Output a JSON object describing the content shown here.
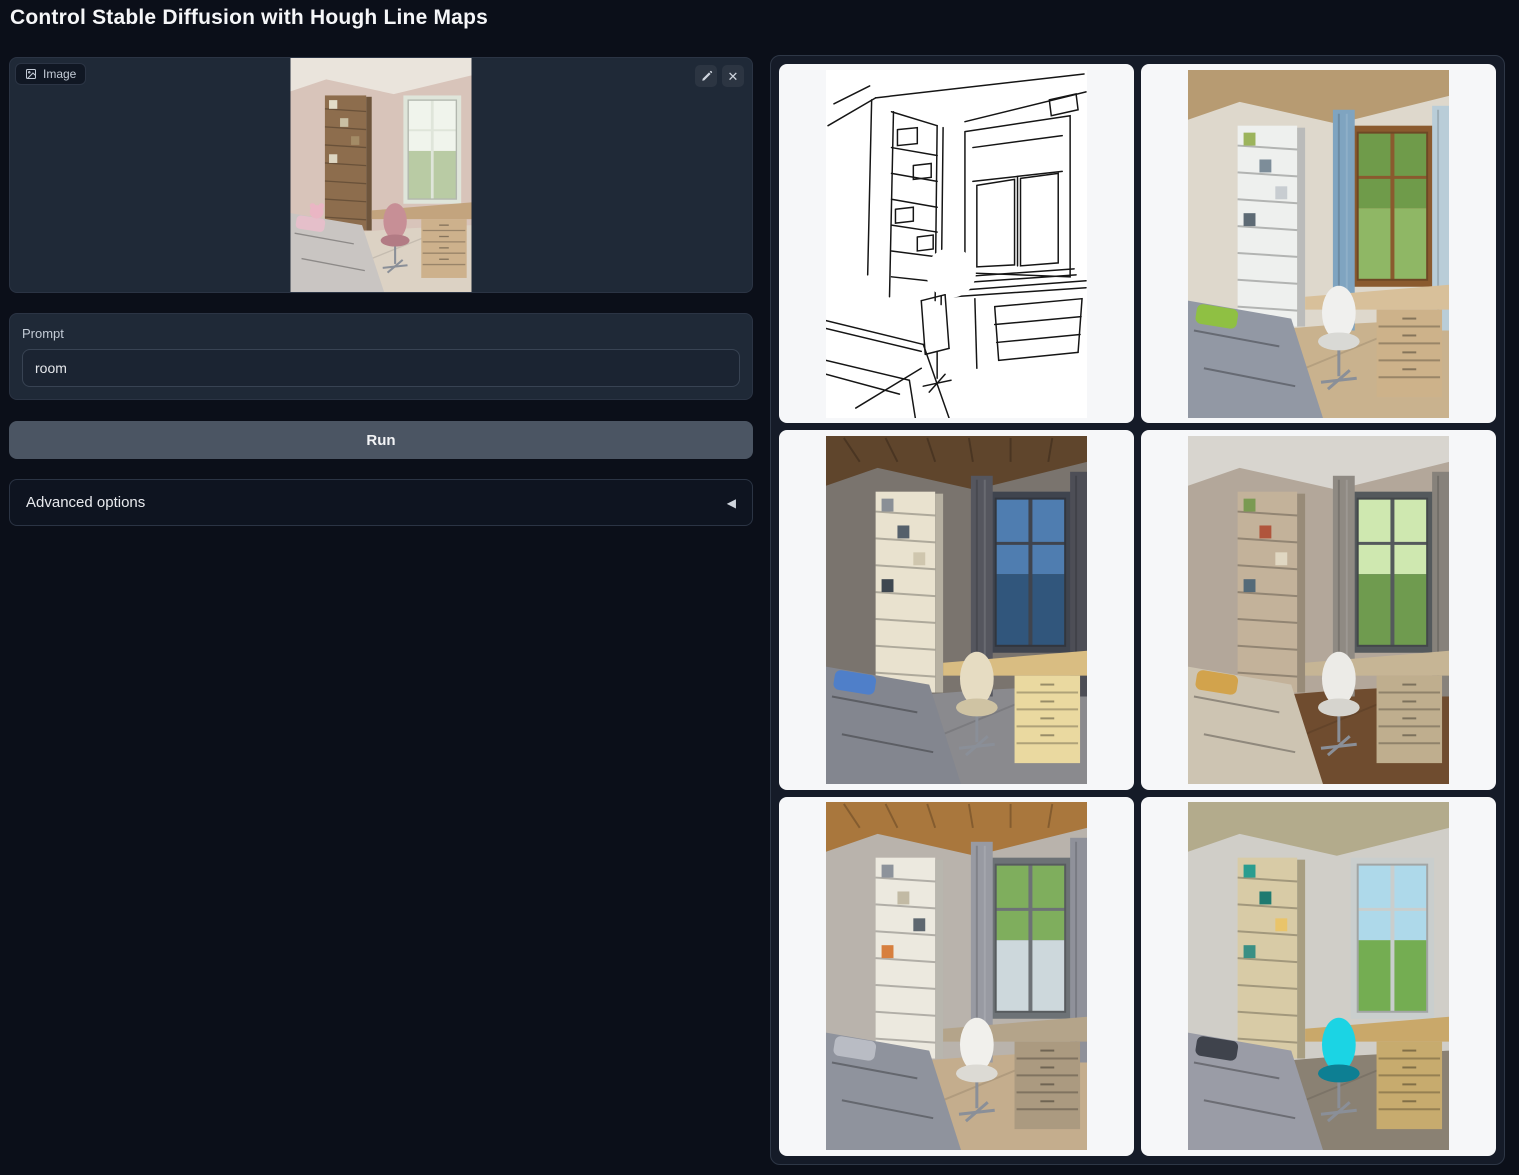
{
  "app": {
    "title": "Control Stable Diffusion with Hough Line Maps"
  },
  "icons": {
    "clear_glyph": "✕",
    "accordion_arrow_glyph": "◀"
  },
  "input_image": {
    "label": "Image",
    "description": "Uploaded photo: small bedroom with wooden shelving unit, desk by a bright window, pink desk chair, grey bed with a pink plush toy",
    "palette": {
      "wall": "#d8c4ba",
      "ceiling": "#eae4dc",
      "ceiling_texture": "plain",
      "shelf": "#8d6d4d",
      "books": [
        "#e3ddc8",
        "#c9bfa3",
        "#a38b66",
        "#ddd6c2"
      ],
      "curtain": null,
      "curtain_right": null,
      "window_frame": "#dfe5da",
      "view_top": "#f0f4ec",
      "view_bottom": "#b9cba4",
      "desk": "#c3a47e",
      "drawer": "#cdb18c",
      "chair": "#c78f96",
      "chair_seat": "#b27b84",
      "bed": "#c9c5c2",
      "pillow": "#e5bfca",
      "plush": "#eab6c4",
      "floor": "#dcd2c4"
    }
  },
  "prompt": {
    "label": "Prompt",
    "value": "room"
  },
  "run_button": {
    "label": "Run"
  },
  "advanced_options": {
    "label": "Advanced options",
    "state": "collapsed"
  },
  "gallery": {
    "items": [
      {
        "type": "hough_line_map",
        "description": "Detected Hough line map of the input room: black perspective line sketch (bookshelf, window, desk, bed) on white"
      },
      {
        "type": "generated_image",
        "description": "Generated bedroom, daylight: blue curtain, white shelving, brown wooden window with green tree view, light wood desk, white chair, grey bed with lime pillow, tan ceiling",
        "palette": {
          "wall": "#ded8cc",
          "ceiling": "#b79b72",
          "ceiling_texture": "plain",
          "shelf": "#eef0ee",
          "books": [
            "#9cb45c",
            "#7d8d99",
            "#c8cdd1",
            "#5d6a74"
          ],
          "curtain": "#7fa4c0",
          "curtain_right": "#b9cdd8",
          "window_frame": "#8a5a2e",
          "view_top": "#6f9b4a",
          "view_bottom": "#8fb765",
          "desk": "#d8c09a",
          "drawer": "#cdb28a",
          "chair": "#f0f0ee",
          "chair_seat": "#d9d9d5",
          "bed": "#9298a4",
          "pillow": "#8fc043",
          "floor": "#c9b28e"
        }
      },
      {
        "type": "generated_image",
        "description": "Generated bedroom at dusk: dark grey curtains, wooden slat ceiling, cream shelving, dusk-blue sea view, warm lit desk drawers, cream chair, grey bed with blue pillow, grey carpet",
        "palette": {
          "wall": "#7a746e",
          "ceiling": "#5f452c",
          "ceiling_texture": "wood",
          "shelf": "#e9e2cf",
          "books": [
            "#8a8f96",
            "#55606b",
            "#cfc6ae",
            "#3e4750"
          ],
          "curtain": "#55565e",
          "curtain_right": "#4d4e56",
          "window_frame": "#3f444e",
          "view_top": "#4f7db0",
          "view_bottom": "#31567c",
          "desk": "#d9bd82",
          "drawer": "#ead9a0",
          "chair": "#e6dcc2",
          "chair_seat": "#cfc3a3",
          "bed": "#83868f",
          "pillow": "#4f7fc9",
          "floor": "#8a8a8e"
        }
      },
      {
        "type": "generated_image",
        "description": "Generated bedroom, beige tones: tall beige bookshelf, taupe walls, white desk chair, bright green tree view, beige bed with mustard pillow, dark wood floor",
        "palette": {
          "wall": "#b3a79a",
          "ceiling": "#d8d5cf",
          "ceiling_texture": "plain",
          "shelf": "#c3b29a",
          "books": [
            "#7a9a52",
            "#b0553c",
            "#e0d7c2",
            "#546a78"
          ],
          "curtain": "#8f8a83",
          "curtain_right": "#87827b",
          "window_frame": "#54595c",
          "view_top": "#cfe8b0",
          "view_bottom": "#6f9b4f",
          "desk": "#c6b595",
          "drawer": "#bfae8e",
          "chair": "#ecebe7",
          "chair_seat": "#d6d4ce",
          "bed": "#cdc4b2",
          "pillow": "#d2a34c",
          "floor": "#6f4c2f"
        }
      },
      {
        "type": "generated_image",
        "description": "Generated bedroom: wooden plank ceiling, grey curtains, white shelving, white chair, window with greenery above pale view, patterned grey bedding, light wood floor",
        "palette": {
          "wall": "#b9b3ac",
          "ceiling": "#a9773d",
          "ceiling_texture": "wood",
          "shelf": "#ece9df",
          "books": [
            "#8d939b",
            "#c2baa4",
            "#5e676f",
            "#d77f3e"
          ],
          "curtain": "#989aa2",
          "curtain_right": "#8f919a",
          "window_frame": "#6d7276",
          "view_top": "#7fae5d",
          "view_bottom": "#cdd8dc",
          "desk": "#b4a48a",
          "drawer": "#ab9a80",
          "chair": "#f1f0ec",
          "chair_seat": "#dcdad4",
          "bed": "#8f939d",
          "pillow": "#b9bcc4",
          "floor": "#c4ad8d"
        }
      },
      {
        "type": "generated_image",
        "description": "Generated bedroom with bright cyan designer chair: light OSB ceiling, light wood shelves with teal books, wooden desk and drawers, white window with sky and bushes, grey bed with dark patterned pillow",
        "palette": {
          "wall": "#d0cec8",
          "ceiling": "#b3ab8c",
          "ceiling_texture": "plain",
          "shelf": "#d8cba6",
          "books": [
            "#2a9d8f",
            "#1f7a70",
            "#e9c46a",
            "#3a8f84"
          ],
          "curtain": null,
          "curtain_right": null,
          "window_frame": "#c9cecd",
          "view_top": "#aed9ea",
          "view_bottom": "#74ad52",
          "desk": "#c9a86a",
          "drawer": "#c7ab6e",
          "chair": "#1bd4e4",
          "chair_seat": "#0d7f93",
          "bed": "#9a9ca6",
          "pillow": "#3f434c",
          "floor": "#8a8173"
        }
      }
    ]
  },
  "colors": {
    "page_bg": "#0b0f19",
    "panel_bg": "#1f2937",
    "panel_border": "#2b3444",
    "input_bg": "#1b2432",
    "input_border": "#384353",
    "run_button_bg": "#4b5563",
    "text": "#e5e7eb",
    "muted_text": "#c3cbd6",
    "gallery_bg": "#151b28",
    "gallery_border": "#2e3746",
    "cell_bg": "#f6f7f9",
    "line_map_stroke": "#151515",
    "line_map_bg": "#ffffff"
  }
}
